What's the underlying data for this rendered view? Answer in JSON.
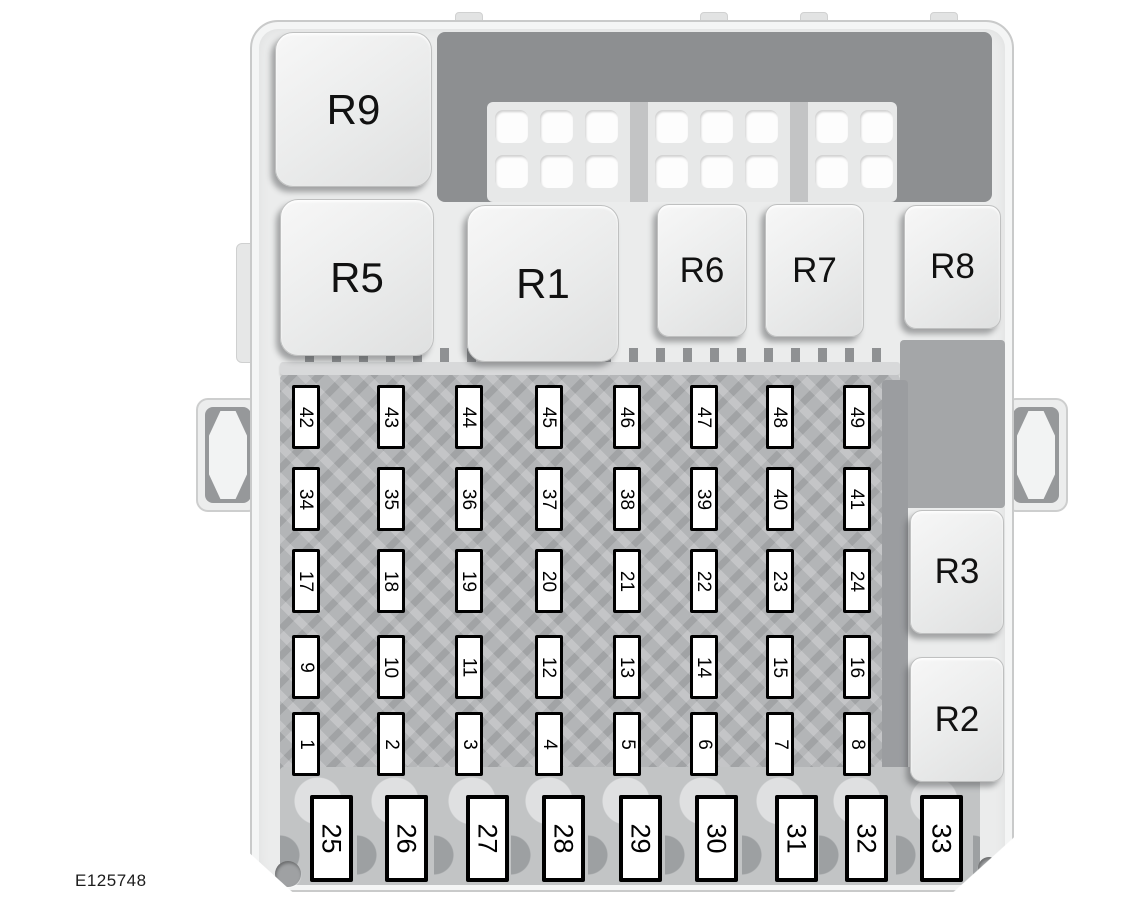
{
  "diagram": {
    "type": "fuse-box-diagram",
    "figure_code": "E125748",
    "relays": [
      {
        "id": "R9",
        "label": "R9"
      },
      {
        "id": "R5",
        "label": "R5"
      },
      {
        "id": "R1",
        "label": "R1"
      },
      {
        "id": "R6",
        "label": "R6"
      },
      {
        "id": "R7",
        "label": "R7"
      },
      {
        "id": "R8",
        "label": "R8"
      },
      {
        "id": "R3",
        "label": "R3"
      },
      {
        "id": "R2",
        "label": "R2"
      }
    ],
    "fuse_grid": {
      "rows": [
        {
          "cells": [
            "42",
            "43",
            "44",
            "45",
            "46",
            "47",
            "48",
            "49"
          ]
        },
        {
          "cells": [
            "34",
            "35",
            "36",
            "37",
            "38",
            "39",
            "40",
            "41"
          ]
        },
        {
          "cells": [
            "17",
            "18",
            "19",
            "20",
            "21",
            "22",
            "23",
            "24"
          ]
        },
        {
          "cells": [
            "9",
            "10",
            "11",
            "12",
            "13",
            "14",
            "15",
            "16"
          ]
        },
        {
          "cells": [
            "1",
            "2",
            "3",
            "4",
            "5",
            "6",
            "7",
            "8"
          ]
        }
      ]
    },
    "bottom_fuse_row": [
      "25",
      "26",
      "27",
      "28",
      "29",
      "30",
      "31",
      "32",
      "33"
    ],
    "colors": {
      "background": "#ffffff",
      "body_light_gray": "#ebecec",
      "rim": "#f4f5f5",
      "panel_dark_gray": "#8d8f91",
      "panel_medium_gray": "#b3b5b7",
      "fuse_fill": "#ffffff",
      "fuse_border": "#000000",
      "label_text": "#111111"
    }
  }
}
